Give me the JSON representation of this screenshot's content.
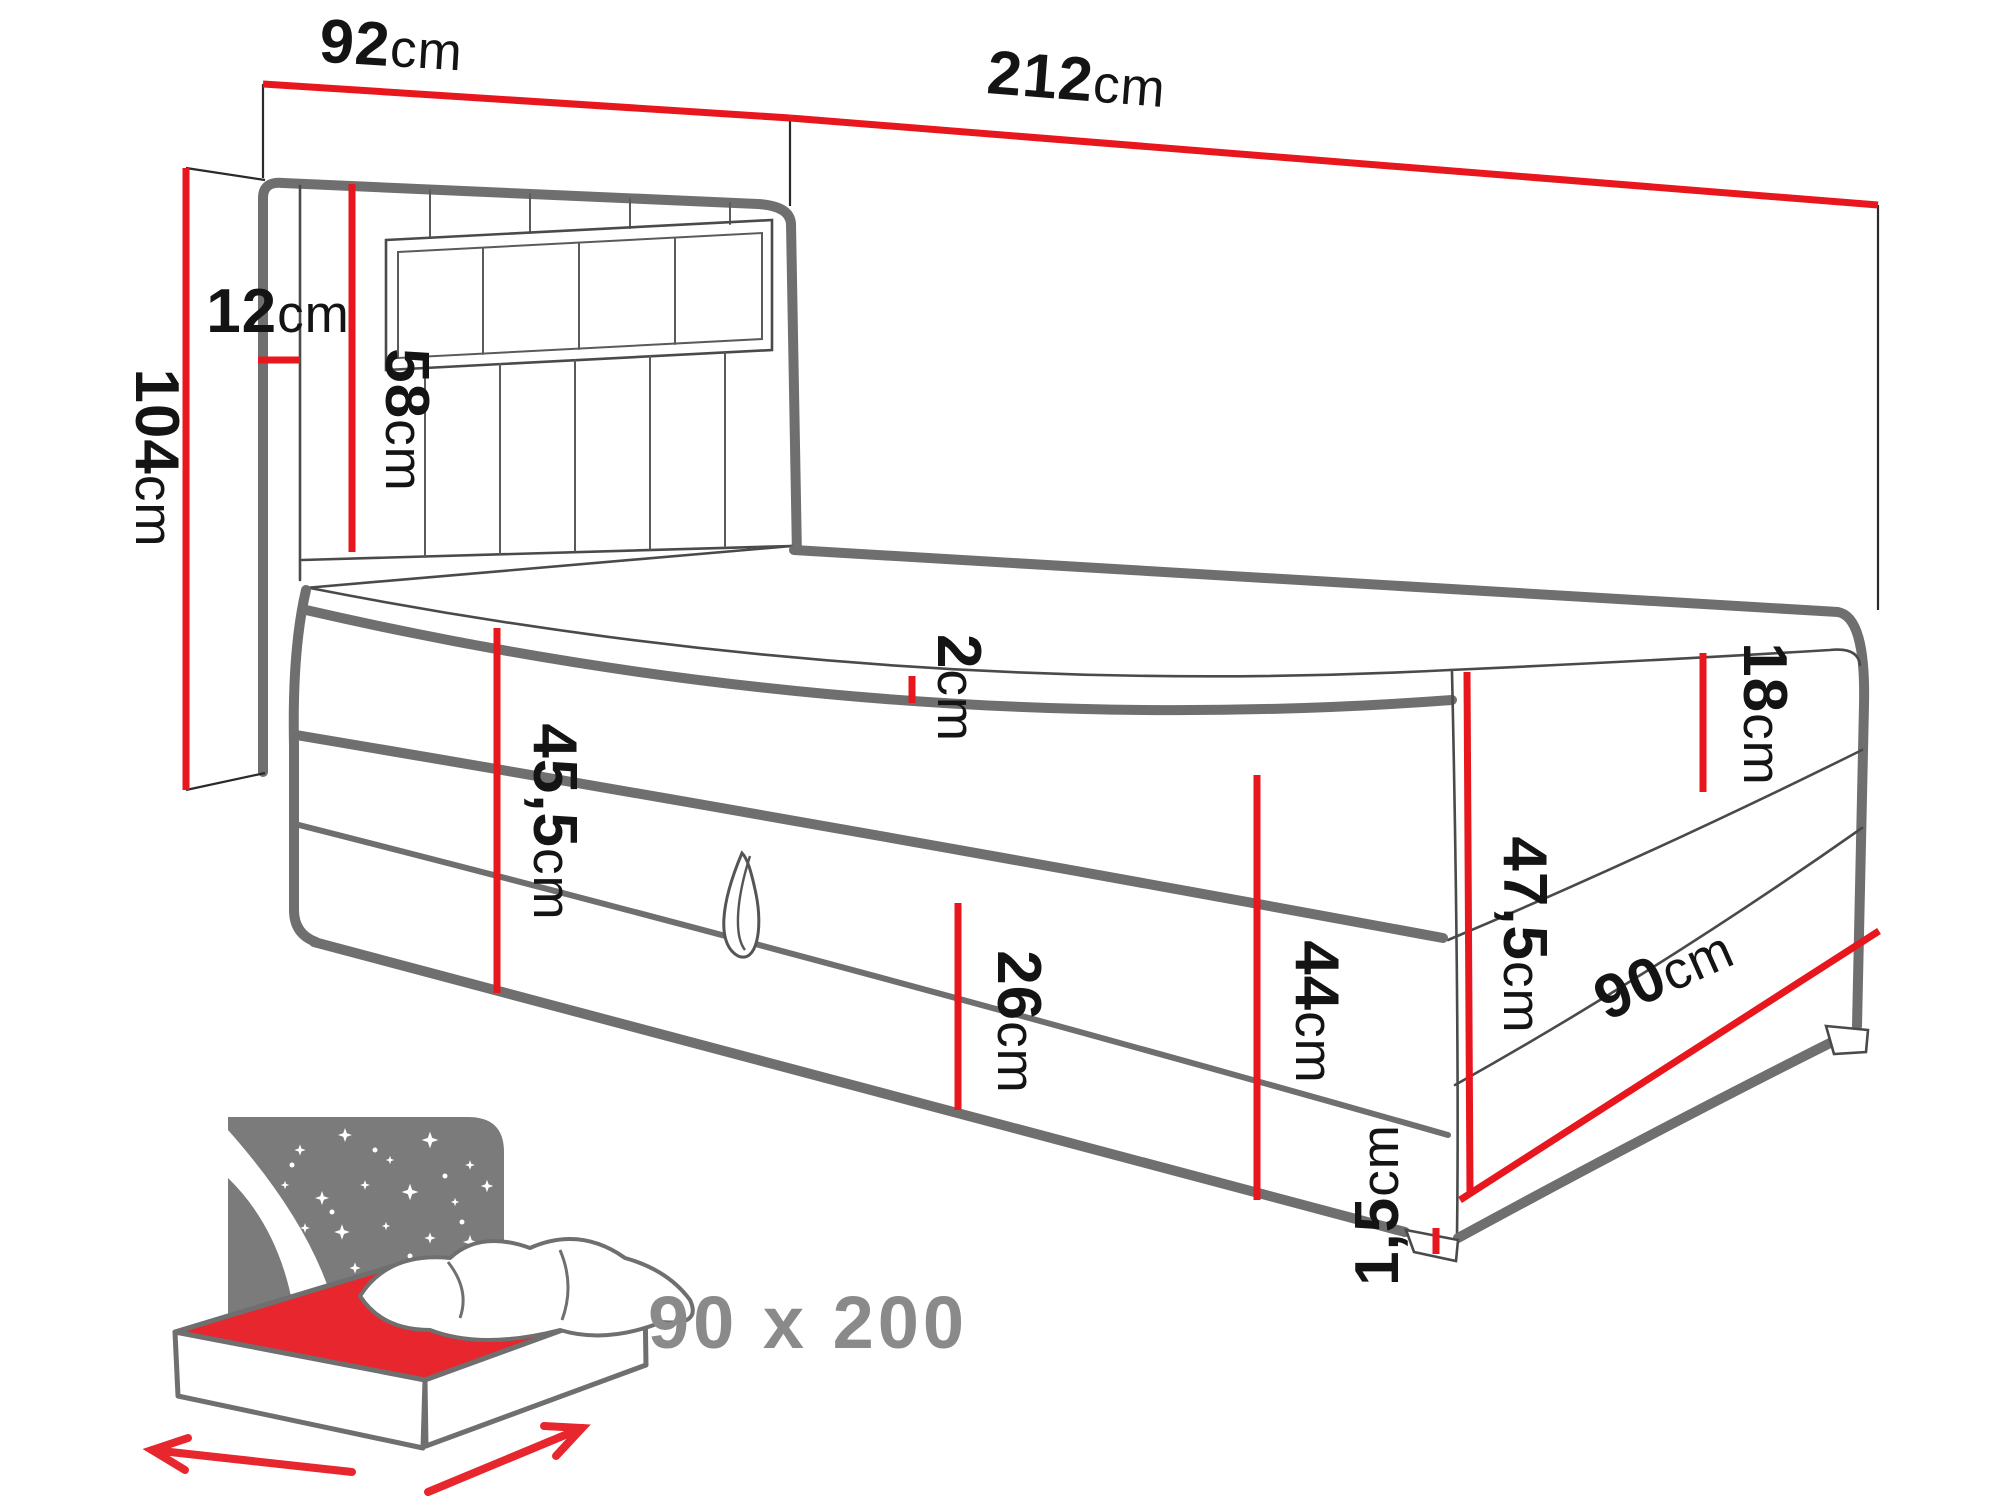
{
  "diagram_type": "bed dimension drawing",
  "dimensions": {
    "headboard_width": {
      "value": "92",
      "unit": "cm"
    },
    "total_length": {
      "value": "212",
      "unit": "cm"
    },
    "total_height": {
      "value": "104",
      "unit": "cm"
    },
    "headboard_depth": {
      "value": "12",
      "unit": "cm"
    },
    "headboard_above_base": {
      "value": "58",
      "unit": "cm"
    },
    "topper_thickness": {
      "value": "2",
      "unit": "cm"
    },
    "base_height_head": {
      "value": "45,5",
      "unit": "cm"
    },
    "storage_box_height": {
      "value": "26",
      "unit": "cm"
    },
    "side_height": {
      "value": "44",
      "unit": "cm"
    },
    "mattress_thickness": {
      "value": "18",
      "unit": "cm"
    },
    "foot_end_height": {
      "value": "47,5",
      "unit": "cm"
    },
    "bed_width": {
      "value": "90",
      "unit": "cm"
    },
    "feet_height": {
      "value": "1,5",
      "unit": "cm"
    }
  },
  "icon": {
    "size_label": "90 x 200"
  },
  "colors": {
    "dimension_red": "#e8161d",
    "outline_gray": "#6f6f6f",
    "icon_background_gray": "#7b7b7b",
    "size_label_gray": "#8a8a8a",
    "text_black": "#141414"
  }
}
